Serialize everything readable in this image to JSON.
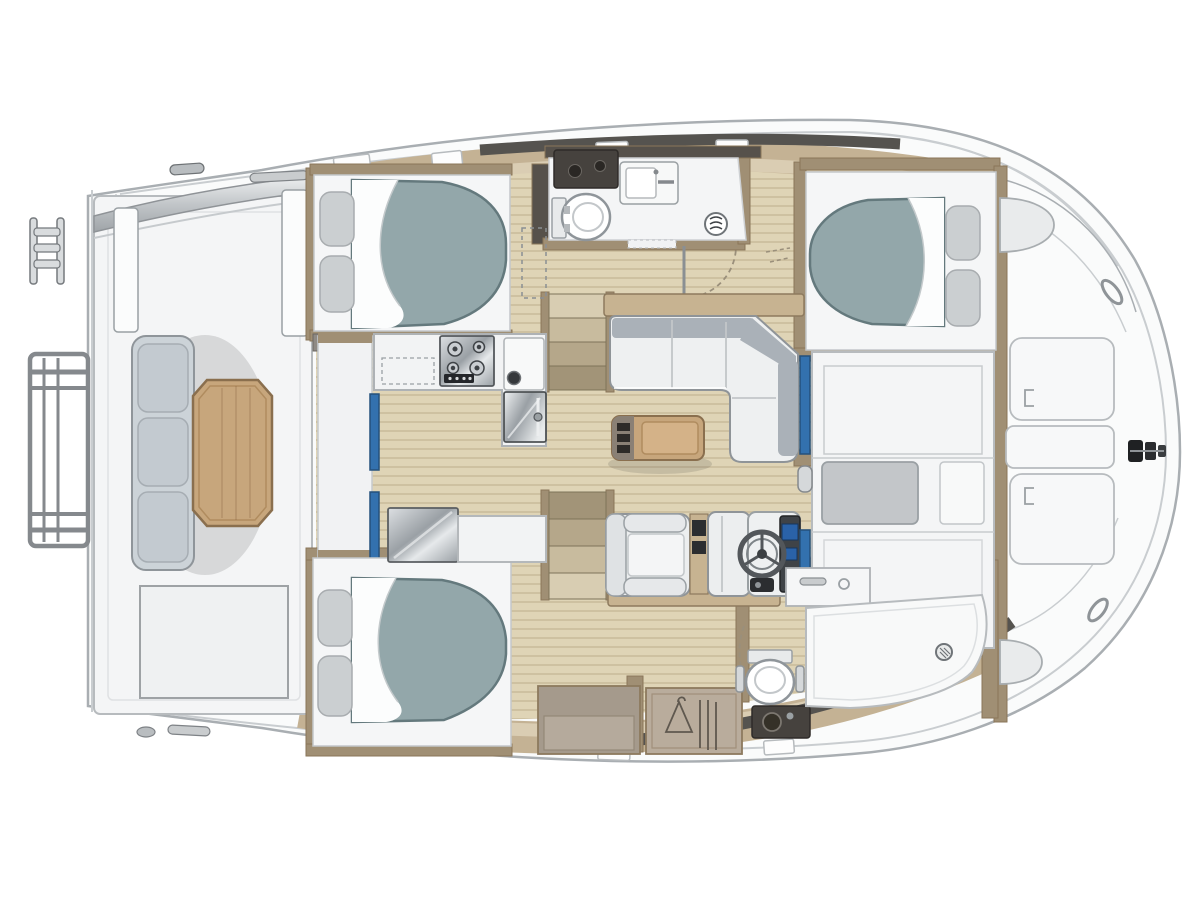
{
  "meta": {
    "type": "floor-plan",
    "subject": "catamaran-yacht-interior-layout",
    "orientation": {
      "bow": "right",
      "stern": "left"
    }
  },
  "colors": {
    "bg": "#ffffff",
    "hullFill": "#fafbfb",
    "hullLine": "#a9aeb2",
    "hullLine2": "#c9cdd0",
    "deckTan": "#c4b294",
    "deckTanLight": "#dacdb3",
    "gunwale": "#55534f",
    "floor": "#dfd4b6",
    "floorLine": "#cec1a1",
    "wallTan": "#a08f74",
    "wallTanDark": "#8a7659",
    "wallDark": "#56514b",
    "white": "#f4f5f6",
    "offWhite": "#eceeef",
    "panelLine": "#b7bbbe",
    "mattress": "#93a7aa",
    "mattressEdge": "#64797d",
    "sheet": "#fcfdfd",
    "pillow": "#cbcfd1",
    "pillowLine": "#a8acaf",
    "sofa": "#eef0f1",
    "sofaBack": "#aab1b8",
    "sofaLine": "#8f9498",
    "woodTable": "#c7a67c",
    "woodTableDark": "#8a6f4e",
    "woodShelf": "#c7b391",
    "steelLight": "#dde0e3",
    "steelMid": "#9aa0a5",
    "steelDark": "#54585c",
    "blue": "#3371ae",
    "blueDark": "#24517c",
    "screen": "#2a62a8",
    "darkFixture": "#46423e",
    "chrome": "#d5d8da",
    "benchSeat": "#ccd3d8",
    "cushionGray": "#c3c6c9",
    "shadow": "rgba(40,40,40,0.14)"
  },
  "areas": [
    {
      "name": "stern-platform",
      "items": [
        "swim-ladder-upper",
        "swim-ladder-lower",
        "targa-arch"
      ]
    },
    {
      "name": "aft-cockpit",
      "items": [
        "bench-seat-3-cushions",
        "octagonal-wood-table"
      ]
    },
    {
      "name": "saloon",
      "items": [
        "l-shaped-sofa",
        "coffee-table",
        "helm-seat",
        "companion-seat",
        "steering-wheel",
        "instrument-panel",
        "galley-stove",
        "galley-sink",
        "galley-oven",
        "galley-fridge",
        "stairs-port",
        "stairs-starboard",
        "sliding-door-aft",
        "sliding-door-forward"
      ]
    },
    {
      "name": "port-hull",
      "items": [
        "aft-cabin-double-bed",
        "head-toilet",
        "head-sink",
        "head-vanity",
        "forward-cabin-double-bed"
      ]
    },
    {
      "name": "starboard-hull",
      "items": [
        "aft-cabin-double-bed",
        "hanging-wardrobe",
        "cabinet",
        "head-toilet",
        "head-vanity",
        "shower-pan",
        "shower-sink"
      ]
    },
    {
      "name": "foredeck",
      "items": [
        "deck-panel-1",
        "deck-panel-2",
        "deck-panel-3",
        "anchor-fitting",
        "deck-hatch-round-port",
        "deck-hatch-round-starboard"
      ]
    }
  ]
}
